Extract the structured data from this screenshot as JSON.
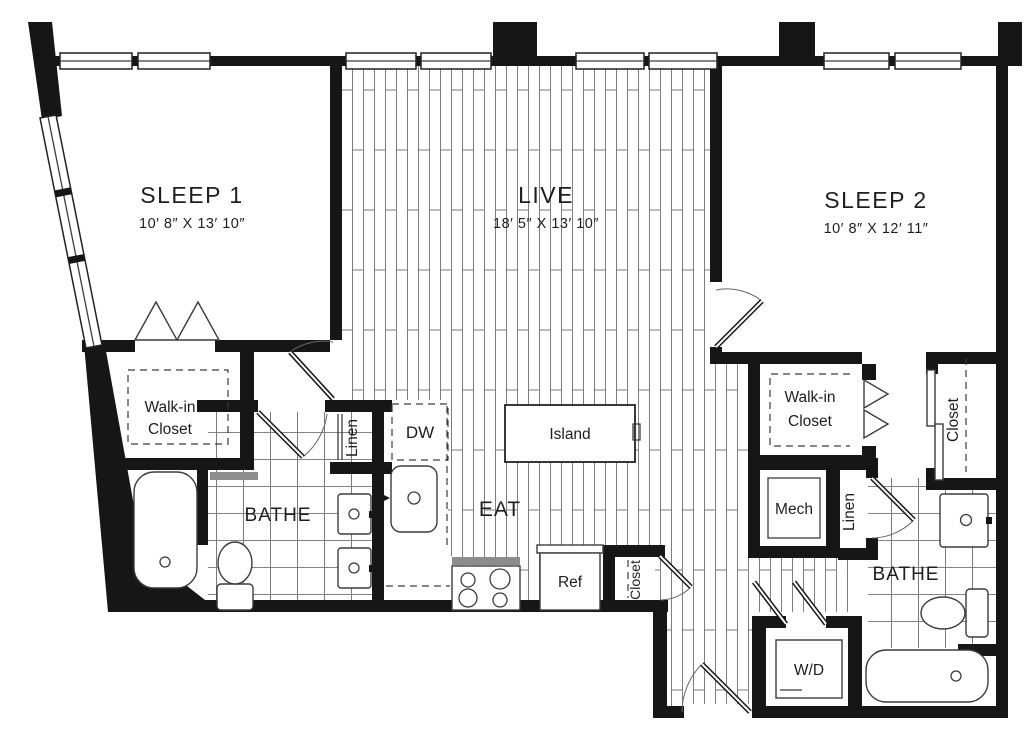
{
  "rooms": {
    "sleep1": {
      "label": "SLEEP 1",
      "dimensions": "10′ 8″ X 13′ 10″"
    },
    "live": {
      "label": "LIVE",
      "dimensions": "18′ 5″ X 13′ 10″"
    },
    "sleep2": {
      "label": "SLEEP 2",
      "dimensions": "10′ 8″ X 12′ 11″"
    },
    "eat": {
      "label": "EAT"
    },
    "bathe1": {
      "label": "BATHE"
    },
    "bathe2": {
      "label": "BATHE"
    },
    "mech": {
      "label": "Mech"
    }
  },
  "closets": {
    "walkin1": {
      "line1": "Walk-in",
      "line2": "Closet"
    },
    "walkin2": {
      "line1": "Walk-in",
      "line2": "Closet"
    },
    "linen1": {
      "label": "Linen"
    },
    "linen2": {
      "label": "Linen"
    },
    "hall_closet": {
      "label": "Closet"
    },
    "sleep2_closet": {
      "label": "Closet"
    }
  },
  "fixtures": {
    "dishwasher": {
      "label": "DW"
    },
    "island": {
      "label": "Island"
    },
    "refrigerator": {
      "label": "Ref"
    },
    "washer_dryer": {
      "label": "W/D"
    }
  },
  "colors": {
    "wall": "#161616",
    "line": "#3c3c3c",
    "background": "#ffffff"
  }
}
